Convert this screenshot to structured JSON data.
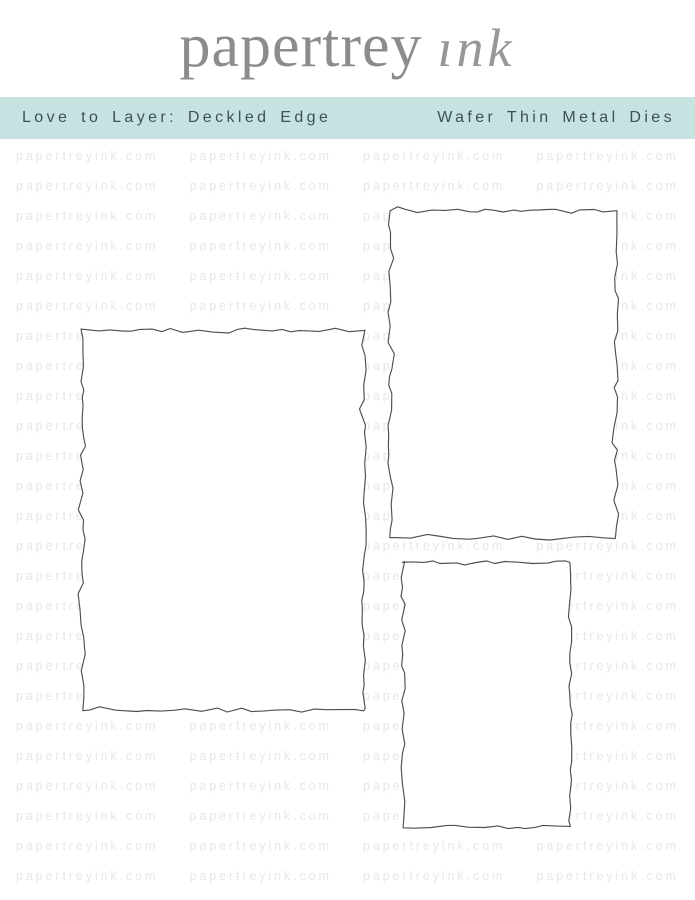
{
  "logo": {
    "serif_text": "papertrey",
    "script_text": "ink",
    "flower_icon": "flower-icon"
  },
  "banner": {
    "left_label": "Love to Layer: Deckled Edge",
    "right_label": "Wafer Thin Metal Dies"
  },
  "watermark": {
    "text": "papertreyink.com"
  },
  "colors": {
    "banner_bg": "#c6e3e2",
    "banner_text": "#3f4f57",
    "logo_gray": "#8c8c8c",
    "script_gray": "#979797",
    "accent_teal": "#55bdc2",
    "watermark_gray": "#e7e7e7",
    "die_outline": "#4f4f4f",
    "background": "#ffffff"
  },
  "dies": [
    {
      "name": "die-large-rectangle",
      "x": 82,
      "y": 330,
      "width": 282,
      "height": 380,
      "seed": 7
    },
    {
      "name": "die-medium-rectangle",
      "x": 390,
      "y": 211,
      "width": 226,
      "height": 327,
      "seed": 13
    },
    {
      "name": "die-small-rectangle",
      "x": 403,
      "y": 563,
      "width": 167,
      "height": 264,
      "seed": 29
    }
  ]
}
